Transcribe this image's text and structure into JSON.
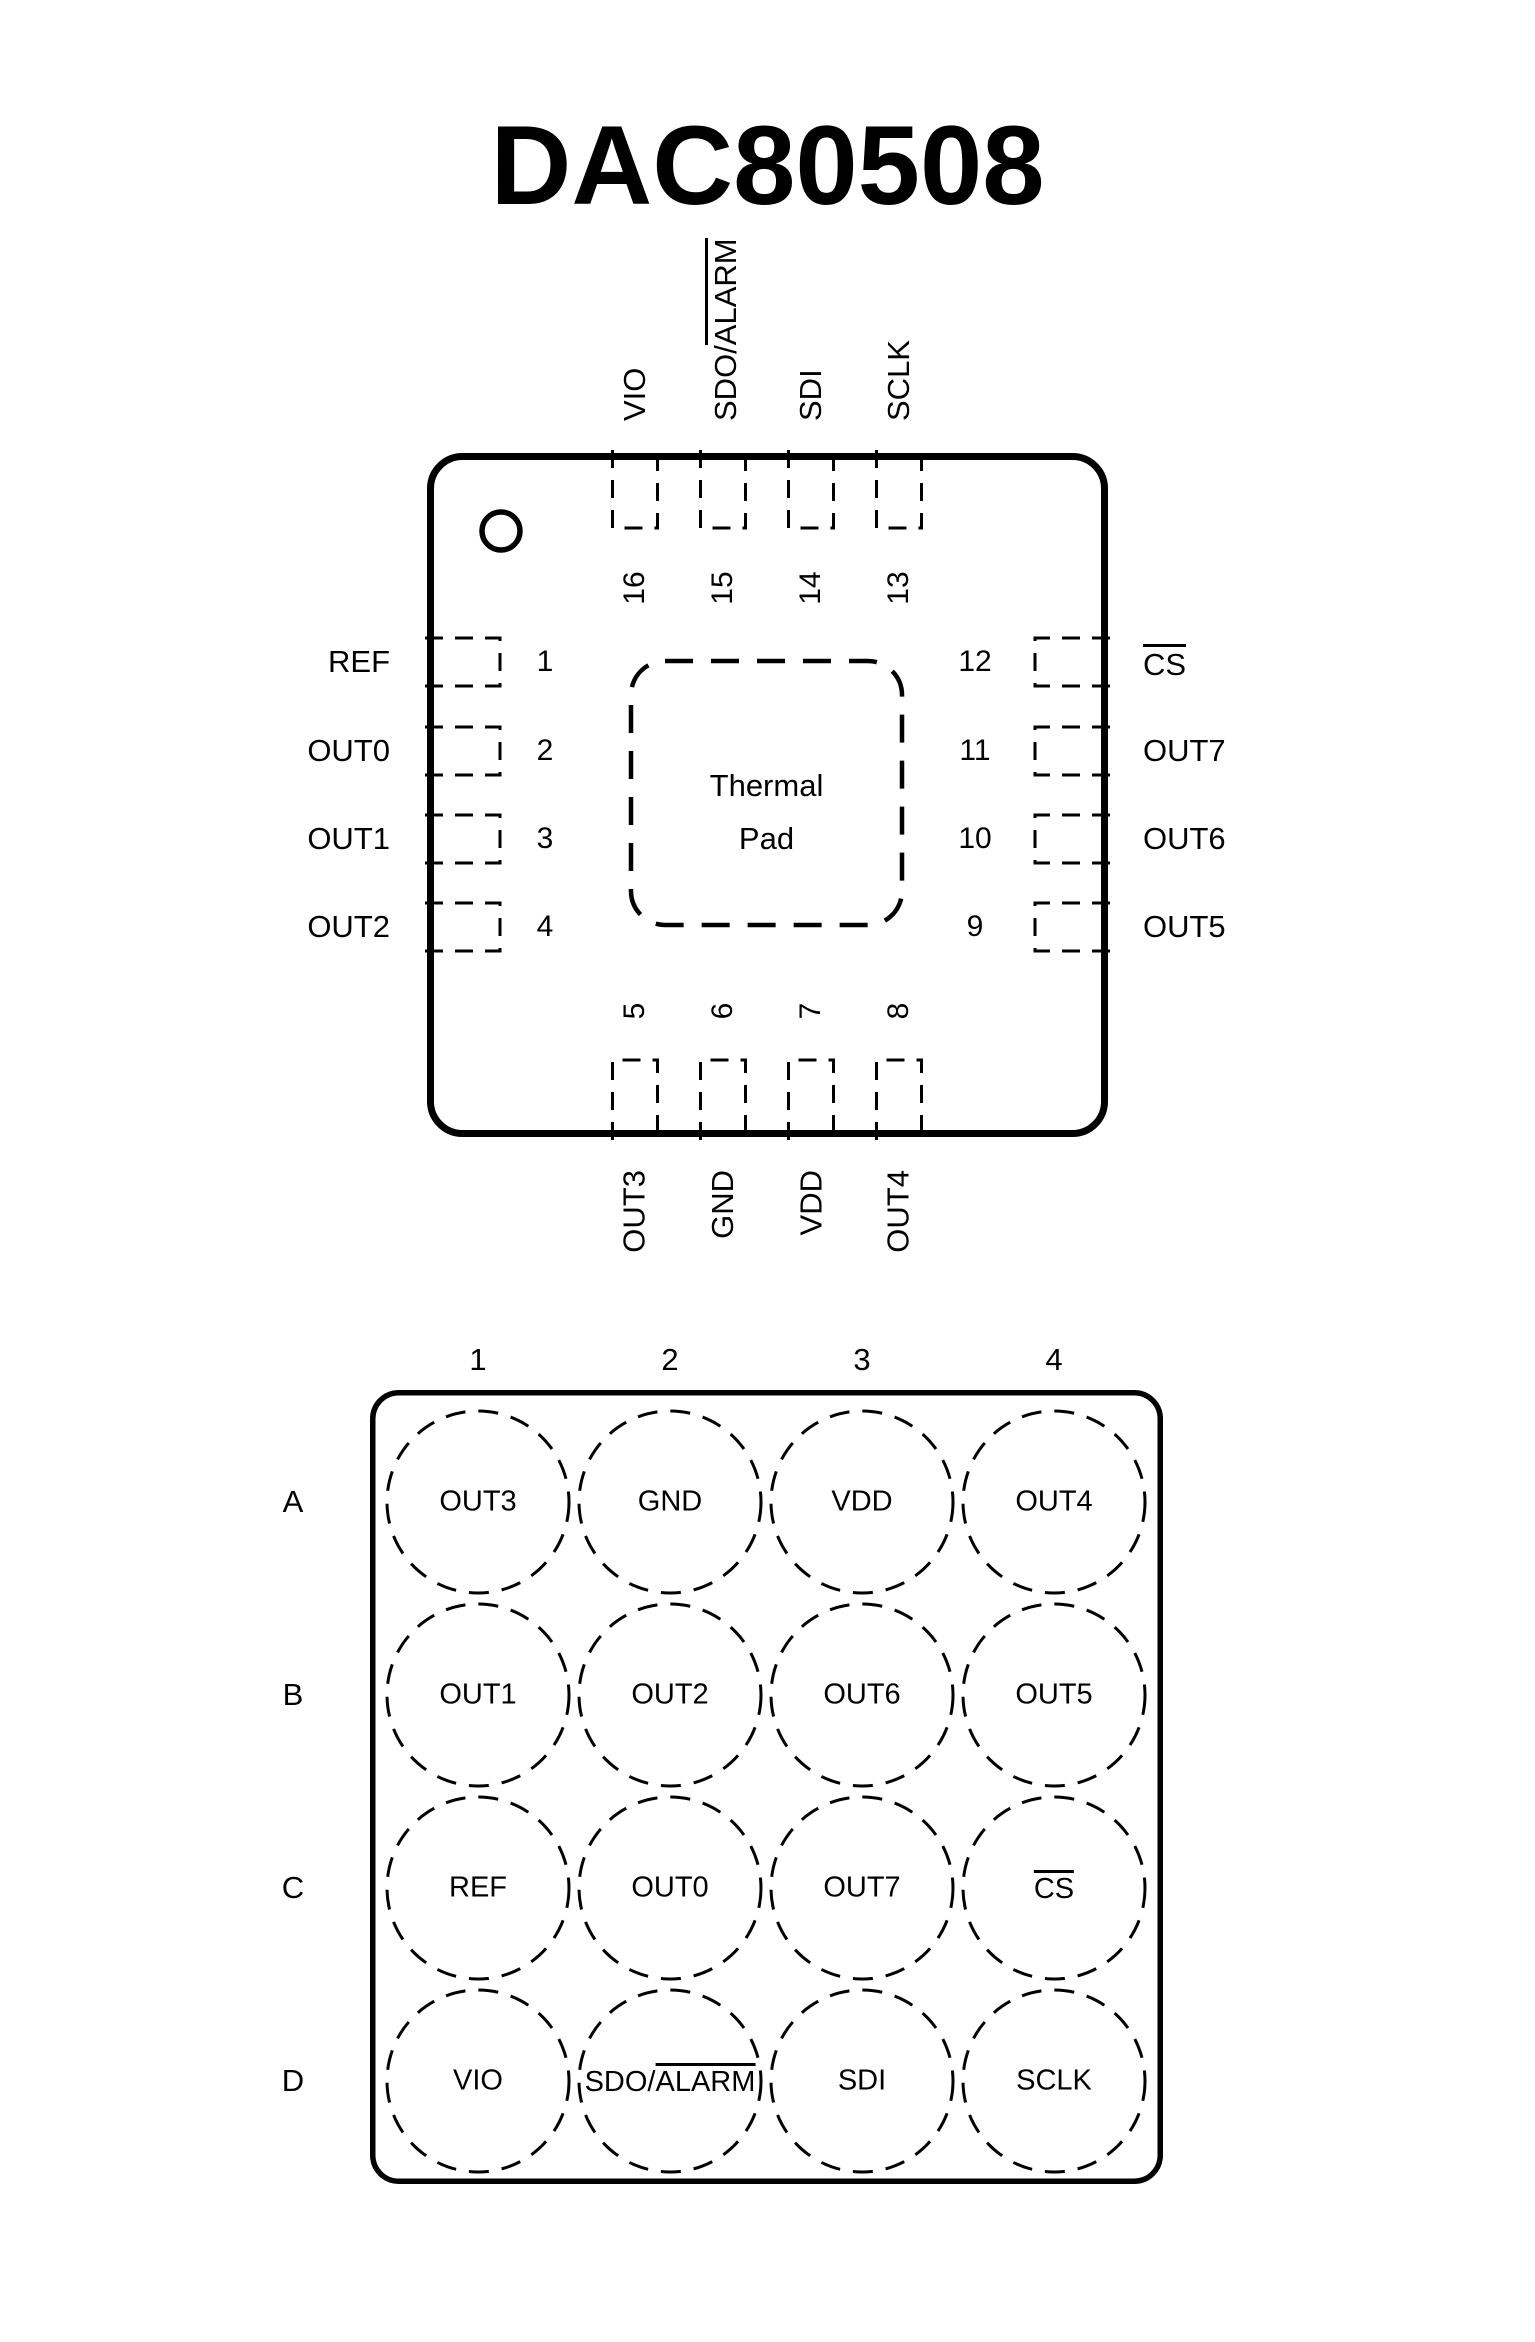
{
  "page": {
    "title": "DAC80508"
  },
  "colors": {
    "ink": "#000000",
    "background": "#ffffff"
  },
  "qfn": {
    "top_pins": [
      {
        "num": "16",
        "label": "VIO"
      },
      {
        "num": "15",
        "label": "SDO/ALARM",
        "bar": "ALARM"
      },
      {
        "num": "14",
        "label": "SDI"
      },
      {
        "num": "13",
        "label": "SCLK"
      }
    ],
    "left_pins": [
      {
        "num": "1",
        "label": "REF"
      },
      {
        "num": "2",
        "label": "OUT0"
      },
      {
        "num": "3",
        "label": "OUT1"
      },
      {
        "num": "4",
        "label": "OUT2"
      }
    ],
    "right_pins": [
      {
        "num": "12",
        "label": "CS",
        "bar": "CS"
      },
      {
        "num": "11",
        "label": "OUT7"
      },
      {
        "num": "10",
        "label": "OUT6"
      },
      {
        "num": "9",
        "label": "OUT5"
      }
    ],
    "bottom_pins": [
      {
        "num": "5",
        "label": "OUT3"
      },
      {
        "num": "6",
        "label": "GND"
      },
      {
        "num": "7",
        "label": "VDD"
      },
      {
        "num": "8",
        "label": "OUT4"
      }
    ],
    "thermal_pad": {
      "line1": "Thermal",
      "line2": "Pad"
    }
  },
  "bga": {
    "col_headers": [
      "1",
      "2",
      "3",
      "4"
    ],
    "row_headers": [
      "A",
      "B",
      "C",
      "D"
    ],
    "balls": [
      [
        {
          "label": "OUT3"
        },
        {
          "label": "GND"
        },
        {
          "label": "VDD"
        },
        {
          "label": "OUT4"
        }
      ],
      [
        {
          "label": "OUT1"
        },
        {
          "label": "OUT2"
        },
        {
          "label": "OUT6"
        },
        {
          "label": "OUT5"
        }
      ],
      [
        {
          "label": "REF"
        },
        {
          "label": "OUT0"
        },
        {
          "label": "OUT7"
        },
        {
          "label": "CS",
          "bar": "CS"
        }
      ],
      [
        {
          "label": "VIO"
        },
        {
          "label": "SDO/ALARM",
          "bar": "ALARM"
        },
        {
          "label": "SDI"
        },
        {
          "label": "SCLK"
        }
      ]
    ]
  }
}
